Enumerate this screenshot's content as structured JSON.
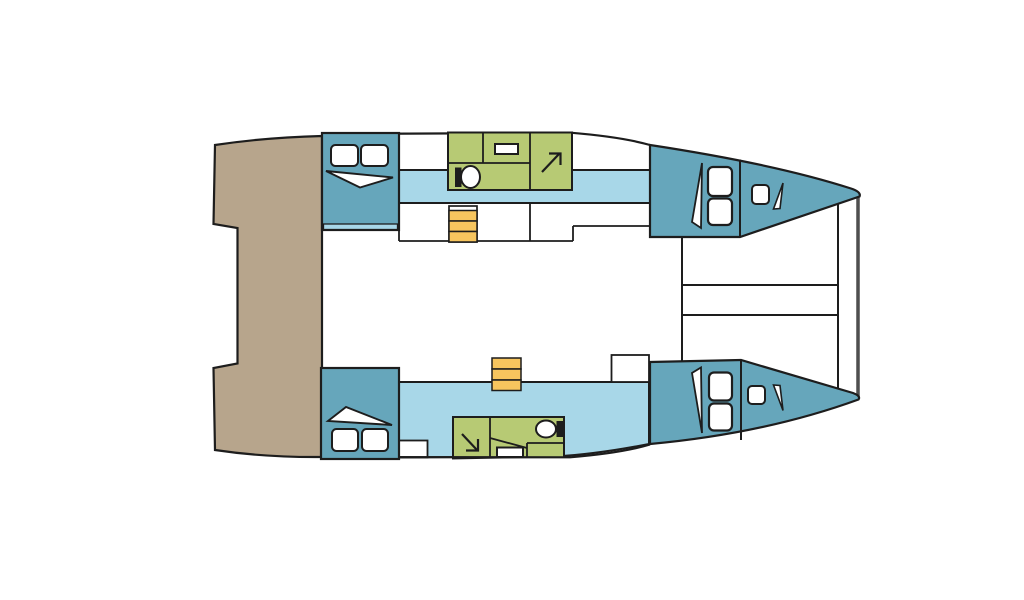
{
  "diagram": {
    "type": "catamaran-deck-plan",
    "canvas": {
      "w": 1024,
      "h": 600,
      "background": "#ffffff"
    },
    "palette": {
      "outline": "#1d1d1d",
      "cabin": "#66a6bb",
      "walkway": "#a8d7e8",
      "bathroom": "#b7ca74",
      "stairs": "#f7c55e",
      "deck": "#b7a58c",
      "white": "#ffffff",
      "beam": "#4f4f4f"
    },
    "shapes": [
      {
        "name": "stern-platform",
        "type": "path",
        "d": "M215,145 Q265,137.5 322,136 L322,457 Q265,457.5 215,450 L213.5,368 L237.5,363.5 L237.5,228 L213.5,224 Z",
        "fill": "deck",
        "stroke": "outline",
        "sw": 2.2
      },
      {
        "name": "hull-top-outline",
        "type": "path",
        "d": "M322,134 L572,132.8 Q622,137 650,145",
        "fill": "none",
        "stroke": "outline",
        "sw": 2.2
      },
      {
        "name": "walkway-top",
        "type": "rect",
        "x": 399,
        "y": 170,
        "w": 251,
        "h": 33,
        "fill": "walkway",
        "stroke": "outline",
        "sw": 2
      },
      {
        "name": "galley-divider-left",
        "type": "line",
        "x1": 399,
        "y1": 203,
        "x2": 399,
        "y2": 241,
        "stroke": "outline",
        "sw": 1.8
      },
      {
        "name": "galley-front-edge",
        "type": "line",
        "x1": 399,
        "y1": 241,
        "x2": 573,
        "y2": 241,
        "stroke": "outline",
        "sw": 1.8
      },
      {
        "name": "galley-step-edge",
        "type": "line",
        "x1": 573,
        "y1": 241,
        "x2": 573,
        "y2": 226,
        "stroke": "outline",
        "sw": 1.8
      },
      {
        "name": "sidedeck-edge-top",
        "type": "line",
        "x1": 573,
        "y1": 226,
        "x2": 650,
        "y2": 226,
        "stroke": "outline",
        "sw": 1.8
      },
      {
        "name": "galley-divider-mid",
        "type": "line",
        "x1": 530,
        "y1": 203,
        "x2": 530,
        "y2": 241,
        "stroke": "outline",
        "sw": 1.8
      },
      {
        "name": "stairs-top-well",
        "type": "rect",
        "x": 449,
        "y": 206,
        "w": 28,
        "h": 36,
        "fill": "white",
        "stroke": "outline",
        "sw": 1.7
      },
      {
        "name": "stairs-top-step-1",
        "type": "rect",
        "x": 449,
        "y": 210.5,
        "w": 28,
        "h": 10.5,
        "fill": "stairs",
        "stroke": "outline",
        "sw": 1.5
      },
      {
        "name": "stairs-top-step-2",
        "type": "rect",
        "x": 449,
        "y": 221,
        "w": 28,
        "h": 10.5,
        "fill": "stairs",
        "stroke": "outline",
        "sw": 1.5
      },
      {
        "name": "stairs-top-step-3",
        "type": "rect",
        "x": 449,
        "y": 231.5,
        "w": 28,
        "h": 10.5,
        "fill": "stairs",
        "stroke": "outline",
        "sw": 1.5
      },
      {
        "name": "bathroom-top",
        "type": "rect",
        "x": 448,
        "y": 132.5,
        "w": 124,
        "h": 57.5,
        "fill": "bathroom",
        "stroke": "outline",
        "sw": 2
      },
      {
        "name": "bathroom-top-wall-1",
        "type": "line",
        "x1": 483,
        "y1": 132.5,
        "x2": 483,
        "y2": 163,
        "stroke": "outline",
        "sw": 1.8
      },
      {
        "name": "bathroom-top-wall-2",
        "type": "line",
        "x1": 448,
        "y1": 163,
        "x2": 530,
        "y2": 163,
        "stroke": "outline",
        "sw": 1.8
      },
      {
        "name": "bathroom-top-wall-3",
        "type": "line",
        "x1": 530,
        "y1": 132.5,
        "x2": 530,
        "y2": 190,
        "stroke": "outline",
        "sw": 1.8
      },
      {
        "name": "toilet-top-tank",
        "type": "rect",
        "x": 455,
        "y": 167.5,
        "w": 6.5,
        "h": 19.5,
        "fill": "outline"
      },
      {
        "name": "toilet-top-bowl",
        "type": "ellipse",
        "cx": 470.5,
        "cy": 177,
        "rx": 9.5,
        "ry": 11,
        "fill": "white",
        "stroke": "outline",
        "sw": 2
      },
      {
        "name": "sink-top",
        "type": "rect",
        "x": 495,
        "y": 144,
        "w": 23,
        "h": 10,
        "fill": "white",
        "stroke": "outline",
        "sw": 2
      },
      {
        "name": "shower-top-arrow",
        "type": "line",
        "x1": 542,
        "y1": 172,
        "x2": 559,
        "y2": 154,
        "stroke": "outline",
        "sw": 2.2
      },
      {
        "name": "shower-top-arrowhead",
        "type": "polyline",
        "pts": "549,153.5 560.5,153.5 560.5,165",
        "fill": "none",
        "stroke": "outline",
        "sw": 2.2
      },
      {
        "name": "cabin-aft-top",
        "type": "rect",
        "x": 322,
        "y": 133,
        "w": 77,
        "h": 97,
        "fill": "cabin",
        "stroke": "outline",
        "sw": 2.2
      },
      {
        "name": "cabin-aft-top-step",
        "type": "rect",
        "x": 323.5,
        "y": 224,
        "w": 74,
        "h": 5.5,
        "fill": "walkway",
        "stroke": "outline",
        "sw": 1.3
      },
      {
        "name": "cabin-aft-top-wedge",
        "type": "polygon",
        "pts": "326,171 393,177.5 360,187.5",
        "fill": "white",
        "stroke": "outline",
        "sw": 1.9
      },
      {
        "name": "cabin-aft-top-pillow-1",
        "type": "rect",
        "x": 331,
        "y": 145,
        "w": 27,
        "h": 21,
        "rx": 4.5,
        "fill": "white",
        "stroke": "outline",
        "sw": 2
      },
      {
        "name": "cabin-aft-top-pillow-2",
        "type": "rect",
        "x": 361,
        "y": 145,
        "w": 27,
        "h": 21,
        "rx": 4.5,
        "fill": "white",
        "stroke": "outline",
        "sw": 2
      },
      {
        "name": "bridge-front-edge",
        "type": "line",
        "x1": 682,
        "y1": 237,
        "x2": 682,
        "y2": 361,
        "stroke": "outline",
        "sw": 2
      },
      {
        "name": "crossbeam-aft",
        "type": "line",
        "x1": 682,
        "y1": 285,
        "x2": 838,
        "y2": 285,
        "stroke": "outline",
        "sw": 2
      },
      {
        "name": "crossbeam-fwd",
        "type": "line",
        "x1": 682,
        "y1": 315,
        "x2": 838,
        "y2": 315,
        "stroke": "outline",
        "sw": 2
      },
      {
        "name": "forebeam",
        "type": "line",
        "x1": 838,
        "y1": 202,
        "x2": 838,
        "y2": 388,
        "stroke": "outline",
        "sw": 2
      },
      {
        "name": "bow-tip-beam",
        "type": "line",
        "x1": 858,
        "y1": 195.5,
        "x2": 858,
        "y2": 396.5,
        "stroke": "beam",
        "sw": 3.5
      },
      {
        "name": "cabin-bow-top",
        "type": "path",
        "d": "M650,145 Q775,164 851,188.5 Q861.5,192 859.5,196.5 L740,237 L650,237 Z",
        "fill": "cabin",
        "stroke": "outline",
        "sw": 2.2
      },
      {
        "name": "cabin-bow-top-bulkhead",
        "type": "line",
        "x1": 740,
        "y1": 159.5,
        "x2": 740,
        "y2": 237,
        "stroke": "outline",
        "sw": 2
      },
      {
        "name": "cabin-bow-top-wedge",
        "type": "polygon",
        "pts": "702,163 692,222 701,228",
        "fill": "white",
        "stroke": "outline",
        "sw": 1.8
      },
      {
        "name": "cabin-bow-top-berth-1",
        "type": "rect",
        "x": 708,
        "y": 167,
        "w": 24,
        "h": 29,
        "rx": 5,
        "fill": "white",
        "stroke": "outline",
        "sw": 2.2
      },
      {
        "name": "cabin-bow-top-berth-2",
        "type": "rect",
        "x": 708,
        "y": 198.5,
        "w": 24,
        "h": 26.5,
        "rx": 5,
        "fill": "white",
        "stroke": "outline",
        "sw": 2.2
      },
      {
        "name": "cabin-bow-top-hatch",
        "type": "rect",
        "x": 752,
        "y": 185,
        "w": 17,
        "h": 19,
        "rx": 4,
        "fill": "white",
        "stroke": "outline",
        "sw": 2
      },
      {
        "name": "cabin-bow-top-wedge-2",
        "type": "polygon",
        "pts": "783,183 773.5,209 780,208.5",
        "fill": "white",
        "stroke": "outline",
        "sw": 1.6
      },
      {
        "name": "walkway-bottom",
        "type": "path",
        "d": "M399,382 L649,382 L649,444 Q598,454 556,456.5 L399,457.5 Z",
        "fill": "walkway",
        "stroke": "outline",
        "sw": 2
      },
      {
        "name": "locker-bottom",
        "type": "rect",
        "x": 399,
        "y": 440.5,
        "w": 28.5,
        "h": 17,
        "fill": "white",
        "stroke": "outline",
        "sw": 1.8
      },
      {
        "name": "bathroom-bottom",
        "type": "rect",
        "x": 453,
        "y": 417,
        "w": 111,
        "h": 42,
        "fill": "bathroom",
        "stroke": "outline",
        "sw": 2
      },
      {
        "name": "bathroom-bottom-wall-1",
        "type": "line",
        "x1": 490,
        "y1": 417,
        "x2": 490,
        "y2": 459,
        "stroke": "outline",
        "sw": 1.8
      },
      {
        "name": "bathroom-bottom-wall-2",
        "type": "line",
        "x1": 490,
        "y1": 438,
        "x2": 527,
        "y2": 448,
        "stroke": "outline",
        "sw": 1.8
      },
      {
        "name": "bathroom-bottom-wall-3",
        "type": "line",
        "x1": 527,
        "y1": 443,
        "x2": 527,
        "y2": 459,
        "stroke": "outline",
        "sw": 1.8
      },
      {
        "name": "bathroom-bottom-wall-4",
        "type": "line",
        "x1": 527,
        "y1": 443,
        "x2": 564,
        "y2": 443,
        "stroke": "outline",
        "sw": 1.8
      },
      {
        "name": "sink-bottom",
        "type": "rect",
        "x": 497,
        "y": 447.5,
        "w": 26,
        "h": 9.5,
        "fill": "white",
        "stroke": "outline",
        "sw": 2
      },
      {
        "name": "toilet-bottom-bowl",
        "type": "ellipse",
        "cx": 546,
        "cy": 429,
        "rx": 10,
        "ry": 8.5,
        "fill": "white",
        "stroke": "outline",
        "sw": 2
      },
      {
        "name": "toilet-bottom-tank",
        "type": "rect",
        "x": 556.5,
        "y": 421,
        "w": 6.5,
        "h": 16,
        "fill": "outline"
      },
      {
        "name": "shower-bottom-arrow",
        "type": "line",
        "x1": 462,
        "y1": 434,
        "x2": 477,
        "y2": 450,
        "stroke": "outline",
        "sw": 2.2
      },
      {
        "name": "shower-bottom-arrowhead",
        "type": "polyline",
        "pts": "466,450.5 478,450.5 478,439",
        "fill": "none",
        "stroke": "outline",
        "sw": 2.2
      },
      {
        "name": "hull-bottom-mask",
        "type": "path",
        "d": "M450,459.5 L556,457.5 Q610,454.5 650,445 L658,472 L450,472 Z",
        "fill": "white"
      },
      {
        "name": "hull-bottom-outline",
        "type": "path",
        "d": "M322,457 L570,457.3 Q622,453 650,444.5",
        "fill": "none",
        "stroke": "outline",
        "sw": 2.2
      },
      {
        "name": "cabin-aft-bottom",
        "type": "rect",
        "x": 321,
        "y": 368,
        "w": 78,
        "h": 91,
        "fill": "cabin",
        "stroke": "outline",
        "sw": 2.2
      },
      {
        "name": "cabin-aft-bottom-wedge",
        "type": "polygon",
        "pts": "328,421 346,407 392,425",
        "fill": "white",
        "stroke": "outline",
        "sw": 1.9
      },
      {
        "name": "cabin-aft-bottom-pillow-1",
        "type": "rect",
        "x": 332,
        "y": 429,
        "w": 26,
        "h": 22,
        "rx": 4.5,
        "fill": "white",
        "stroke": "outline",
        "sw": 2
      },
      {
        "name": "cabin-aft-bottom-pillow-2",
        "type": "rect",
        "x": 362,
        "y": 429,
        "w": 26,
        "h": 22,
        "rx": 4.5,
        "fill": "white",
        "stroke": "outline",
        "sw": 2
      },
      {
        "name": "stairs-bottom-step-1",
        "type": "rect",
        "x": 492,
        "y": 358,
        "w": 29,
        "h": 11,
        "fill": "stairs",
        "stroke": "outline",
        "sw": 1.5
      },
      {
        "name": "stairs-bottom-step-2",
        "type": "rect",
        "x": 492,
        "y": 369,
        "w": 29,
        "h": 11,
        "fill": "stairs",
        "stroke": "outline",
        "sw": 1.5
      },
      {
        "name": "stairs-bottom-step-3",
        "type": "rect",
        "x": 492,
        "y": 380,
        "w": 29,
        "h": 10.5,
        "fill": "stairs",
        "stroke": "outline",
        "sw": 1.5
      },
      {
        "name": "saloon-unit-bottom",
        "type": "rect",
        "x": 611.5,
        "y": 355,
        "w": 37.5,
        "h": 27,
        "fill": "white",
        "stroke": "outline",
        "sw": 1.8
      },
      {
        "name": "cabin-bow-bottom",
        "type": "path",
        "d": "M650,362 L741,360 L853,393 Q861,396 858.5,399.5 Q765,433.5 650,444 Z",
        "fill": "cabin",
        "stroke": "outline",
        "sw": 2.2
      },
      {
        "name": "cabin-bow-bottom-bulkhead",
        "type": "line",
        "x1": 741,
        "y1": 360,
        "x2": 741,
        "y2": 440,
        "stroke": "outline",
        "sw": 2
      },
      {
        "name": "cabin-bow-bottom-wedge",
        "type": "polygon",
        "pts": "702,433 692,373 701,367.5",
        "fill": "white",
        "stroke": "outline",
        "sw": 1.8
      },
      {
        "name": "cabin-bow-bottom-berth-1",
        "type": "rect",
        "x": 709,
        "y": 372.5,
        "w": 23,
        "h": 28,
        "rx": 5,
        "fill": "white",
        "stroke": "outline",
        "sw": 2.2
      },
      {
        "name": "cabin-bow-bottom-berth-2",
        "type": "rect",
        "x": 709,
        "y": 403.5,
        "w": 23,
        "h": 27,
        "rx": 5,
        "fill": "white",
        "stroke": "outline",
        "sw": 2.2
      },
      {
        "name": "cabin-bow-bottom-hatch",
        "type": "rect",
        "x": 748,
        "y": 386,
        "w": 17,
        "h": 18,
        "rx": 4,
        "fill": "white",
        "stroke": "outline",
        "sw": 2
      },
      {
        "name": "cabin-bow-bottom-wedge-2",
        "type": "polygon",
        "pts": "783,410.5 773.5,385 780,385.5",
        "fill": "white",
        "stroke": "outline",
        "sw": 1.6
      }
    ]
  }
}
